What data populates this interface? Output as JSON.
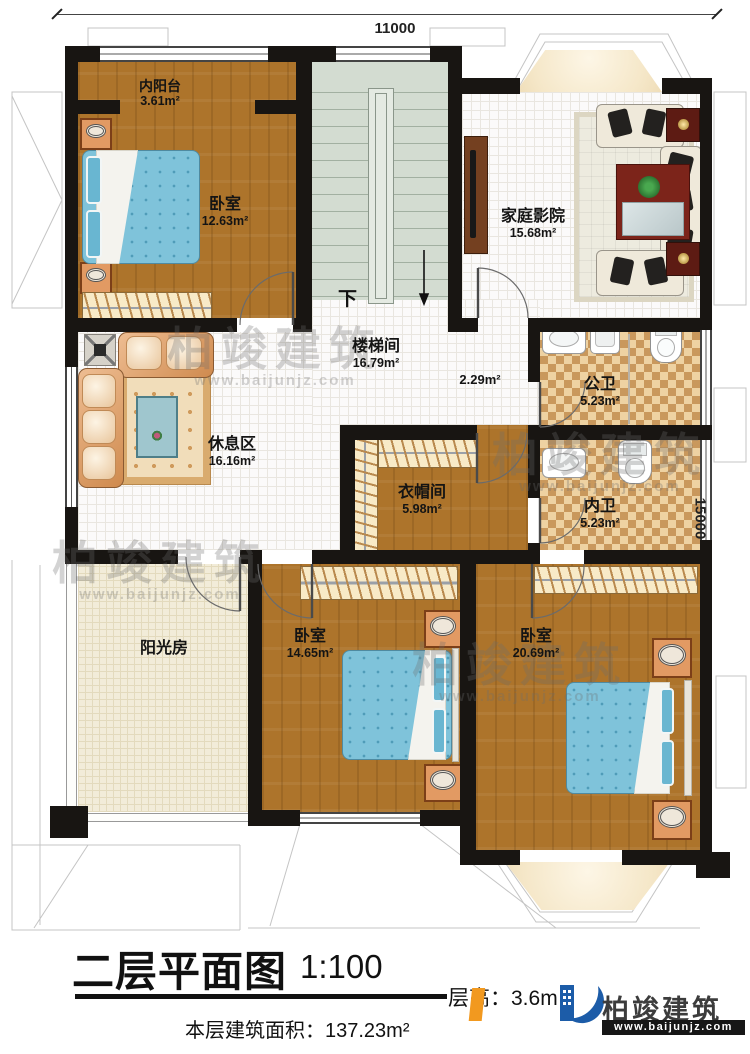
{
  "dimensions": {
    "top": "11000",
    "right": "15000"
  },
  "stairs": {
    "down": "下"
  },
  "rooms": {
    "balcony": {
      "name": "内阳台",
      "area": "3.61m²"
    },
    "bedroom_tl": {
      "name": "卧室",
      "area": "12.63m²"
    },
    "stairwell": {
      "name": "楼梯间",
      "area": "16.79m²"
    },
    "home_theater": {
      "name": "家庭影院",
      "area": "15.68m²"
    },
    "corridor": {
      "area": "2.29m²"
    },
    "rest_area": {
      "name": "休息区",
      "area": "16.16m²"
    },
    "public_bath": {
      "name": "公卫",
      "area": "5.23m²"
    },
    "inner_bath": {
      "name": "内卫",
      "area": "5.23m²"
    },
    "cloakroom": {
      "name": "衣帽间",
      "area": "5.98m²"
    },
    "sunroom": {
      "name": "阳光房"
    },
    "bedroom_bm": {
      "name": "卧室",
      "area": "14.65m²"
    },
    "bedroom_br": {
      "name": "卧室",
      "area": "20.69m²"
    }
  },
  "title_block": {
    "title": "二层平面图",
    "scale": "1:100",
    "floor_height_label": "层高：",
    "floor_height_value": "3.6m",
    "floor_area_label": "本层建筑面积：",
    "floor_area_value": "137.23m²"
  },
  "logo": {
    "brand": "柏竣建筑",
    "url": "www.baijunjz.com"
  },
  "watermark": {
    "brand": "柏竣建筑",
    "url": "www.baijunjz.com"
  },
  "colors": {
    "wall": "#181512",
    "wood_floor": "#ad742b",
    "stair_floor": "#d3dcd1",
    "checker_tile": "#c9985c",
    "sun_floor": "#f2ecd9",
    "bed_blue": "#7fc3da",
    "logo_blue": "#1c5ca8",
    "logo_orange": "#f2991f"
  }
}
